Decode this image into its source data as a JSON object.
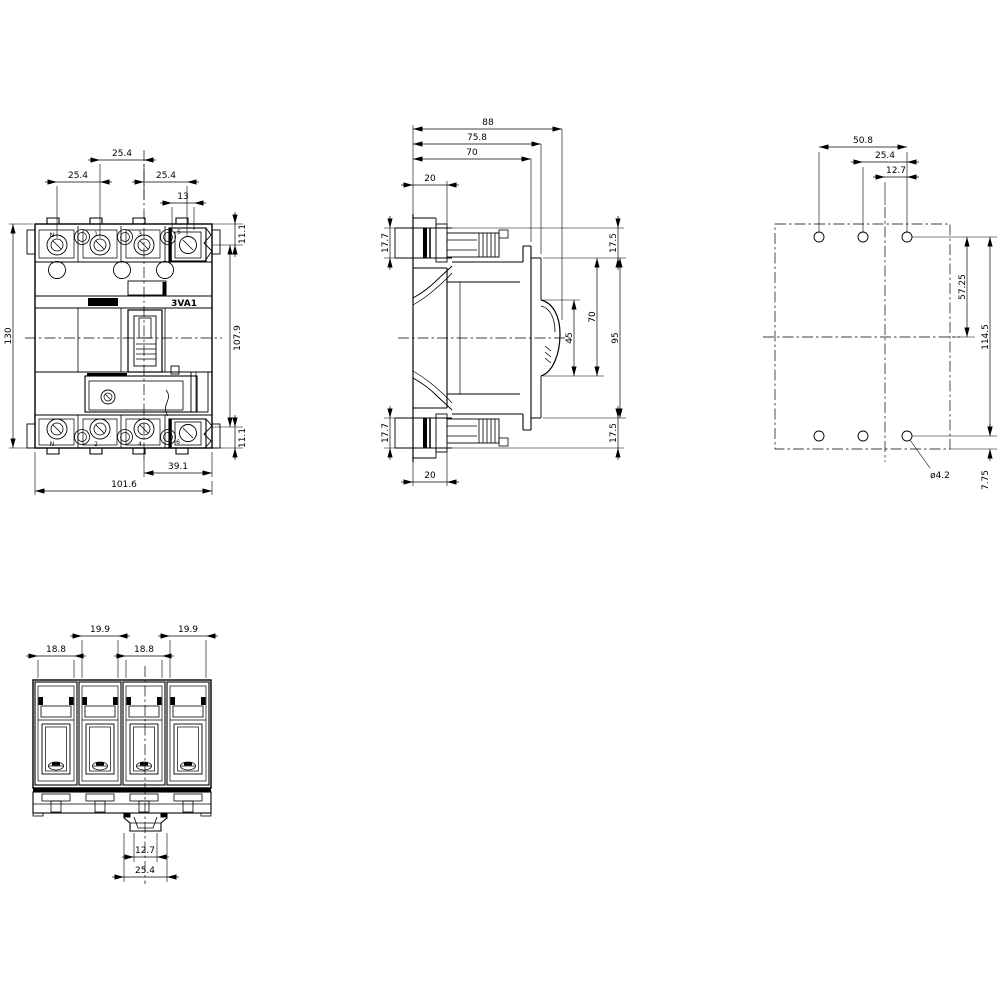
{
  "colors": {
    "line": "#000000",
    "background": "#ffffff"
  },
  "front_view": {
    "label": "3VA1",
    "poles_top": [
      "N",
      "1",
      "3",
      "5"
    ],
    "poles_bottom": [
      "N",
      "2",
      "4",
      "6"
    ],
    "dims": {
      "pitch_mid": "25.4",
      "pitch_left": "25.4",
      "pitch_right": "25.4",
      "n_width": "13",
      "offset_top": "11.1",
      "offset_bottom": "11.1",
      "height": "130",
      "terminal_span": "107.9",
      "center_to_edge": "39.1",
      "width": "101.6"
    }
  },
  "side_view": {
    "dims": {
      "depth_total": "88",
      "depth_to_escutcheon": "75.8",
      "depth_body": "70",
      "terminal_depth_top": "20",
      "terminal_depth_bottom": "20",
      "terminal_height_top": "17.7",
      "terminal_height_bottom": "17.7",
      "cover_height_top": "17.5",
      "cover_height_bottom": "17.5",
      "front_height": "95",
      "escutcheon_height": "70",
      "handle_window": "45"
    }
  },
  "drilling_view": {
    "dims": {
      "hole_span": "50.8",
      "hole_pitch": "25.4",
      "hole_half_pitch": "12.7",
      "center_to_hole_row": "57.25",
      "hole_row_span": "114.5",
      "bottom_edge_offset": "7.75",
      "hole_diameter": "ø4.2"
    }
  },
  "bottom_view": {
    "dims": {
      "slot1": "18.8",
      "slot2": "19.9",
      "slot3": "18.8",
      "slot4": "19.9",
      "tab_inner": "12.7",
      "tab_outer": "25.4"
    }
  }
}
